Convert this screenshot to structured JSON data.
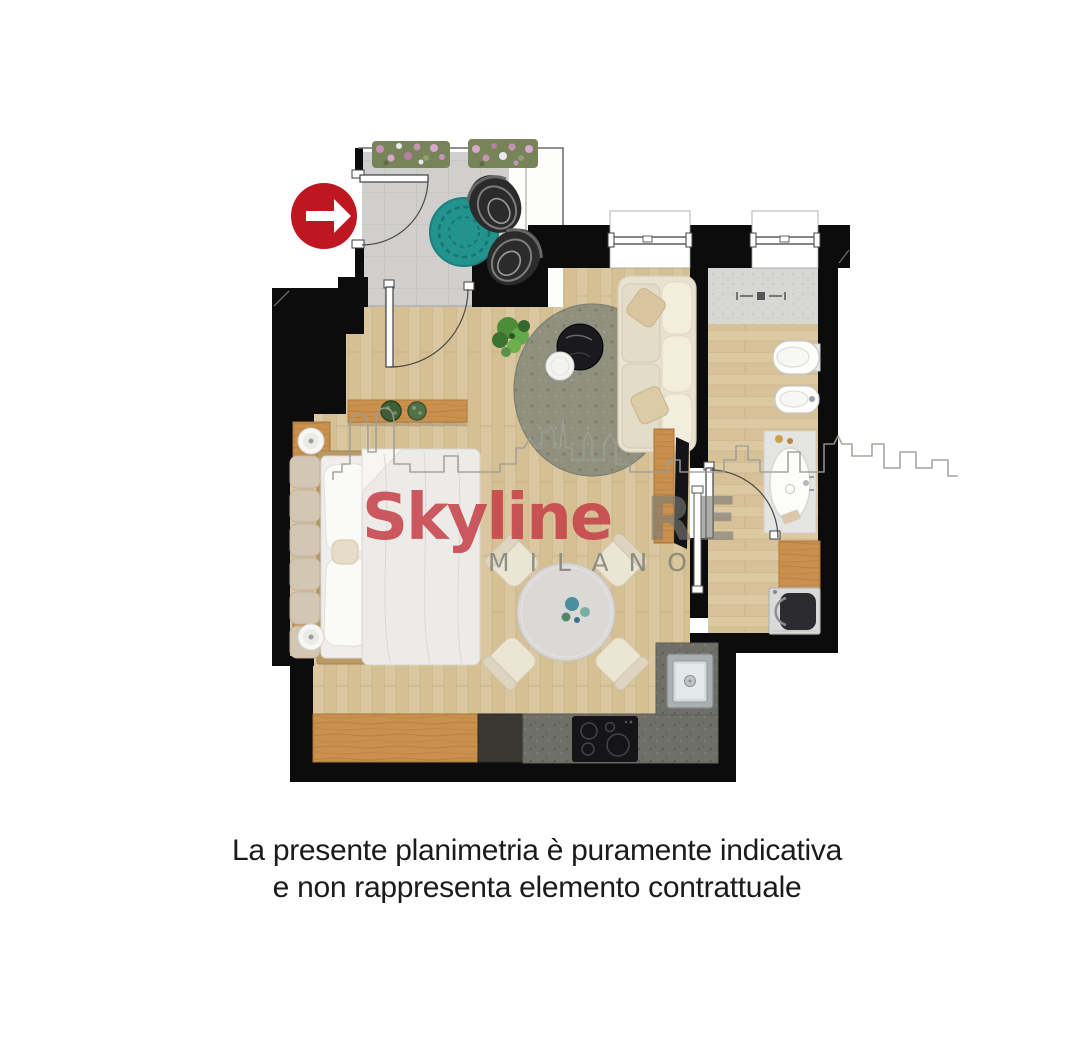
{
  "page": {
    "width": 1074,
    "height": 1050,
    "background": "#ffffff"
  },
  "entrance": {
    "icon": "arrow-right-icon",
    "circle_color": "#bf1722",
    "arrow_color": "#ffffff"
  },
  "watermark": {
    "brand": "Skyline",
    "suffix": "RE",
    "city": "MILANO",
    "brand_color": "rgba(197,62,70,0.85)",
    "suffix_color": "rgba(122,122,116,0.62)",
    "city_color": "rgba(128,128,121,0.85)"
  },
  "caption": {
    "line1": "La presente planimetria è puramente indicativa",
    "line2": "e non rappresenta elemento contrattuale",
    "color": "#1b1b1b"
  },
  "palette": {
    "wall": "#0c0c0c",
    "wood_floor": "#dbc79f",
    "balcony_tile": "#d0cfcd",
    "shower_tile": "#d7d7d5",
    "counter": "#6f6f69",
    "cabinet_wood": "#c9904e",
    "living_rug": "#8f917e",
    "balcony_rug": "#23938f"
  },
  "rooms": [
    "terrace",
    "living-dining-area",
    "sleeping-area",
    "kitchen",
    "bathroom"
  ],
  "furniture": [
    "terrace planters",
    "wicker chairs",
    "round teal rug",
    "double bed",
    "nightstands with lamps",
    "wall shelf with plants",
    "sofa",
    "coffee tables",
    "tv sideboard",
    "round dining table with four chairs",
    "kitchen counter with hob and sink",
    "shower",
    "toilet",
    "bidet",
    "vanity basin",
    "wooden bench",
    "washing machine"
  ]
}
